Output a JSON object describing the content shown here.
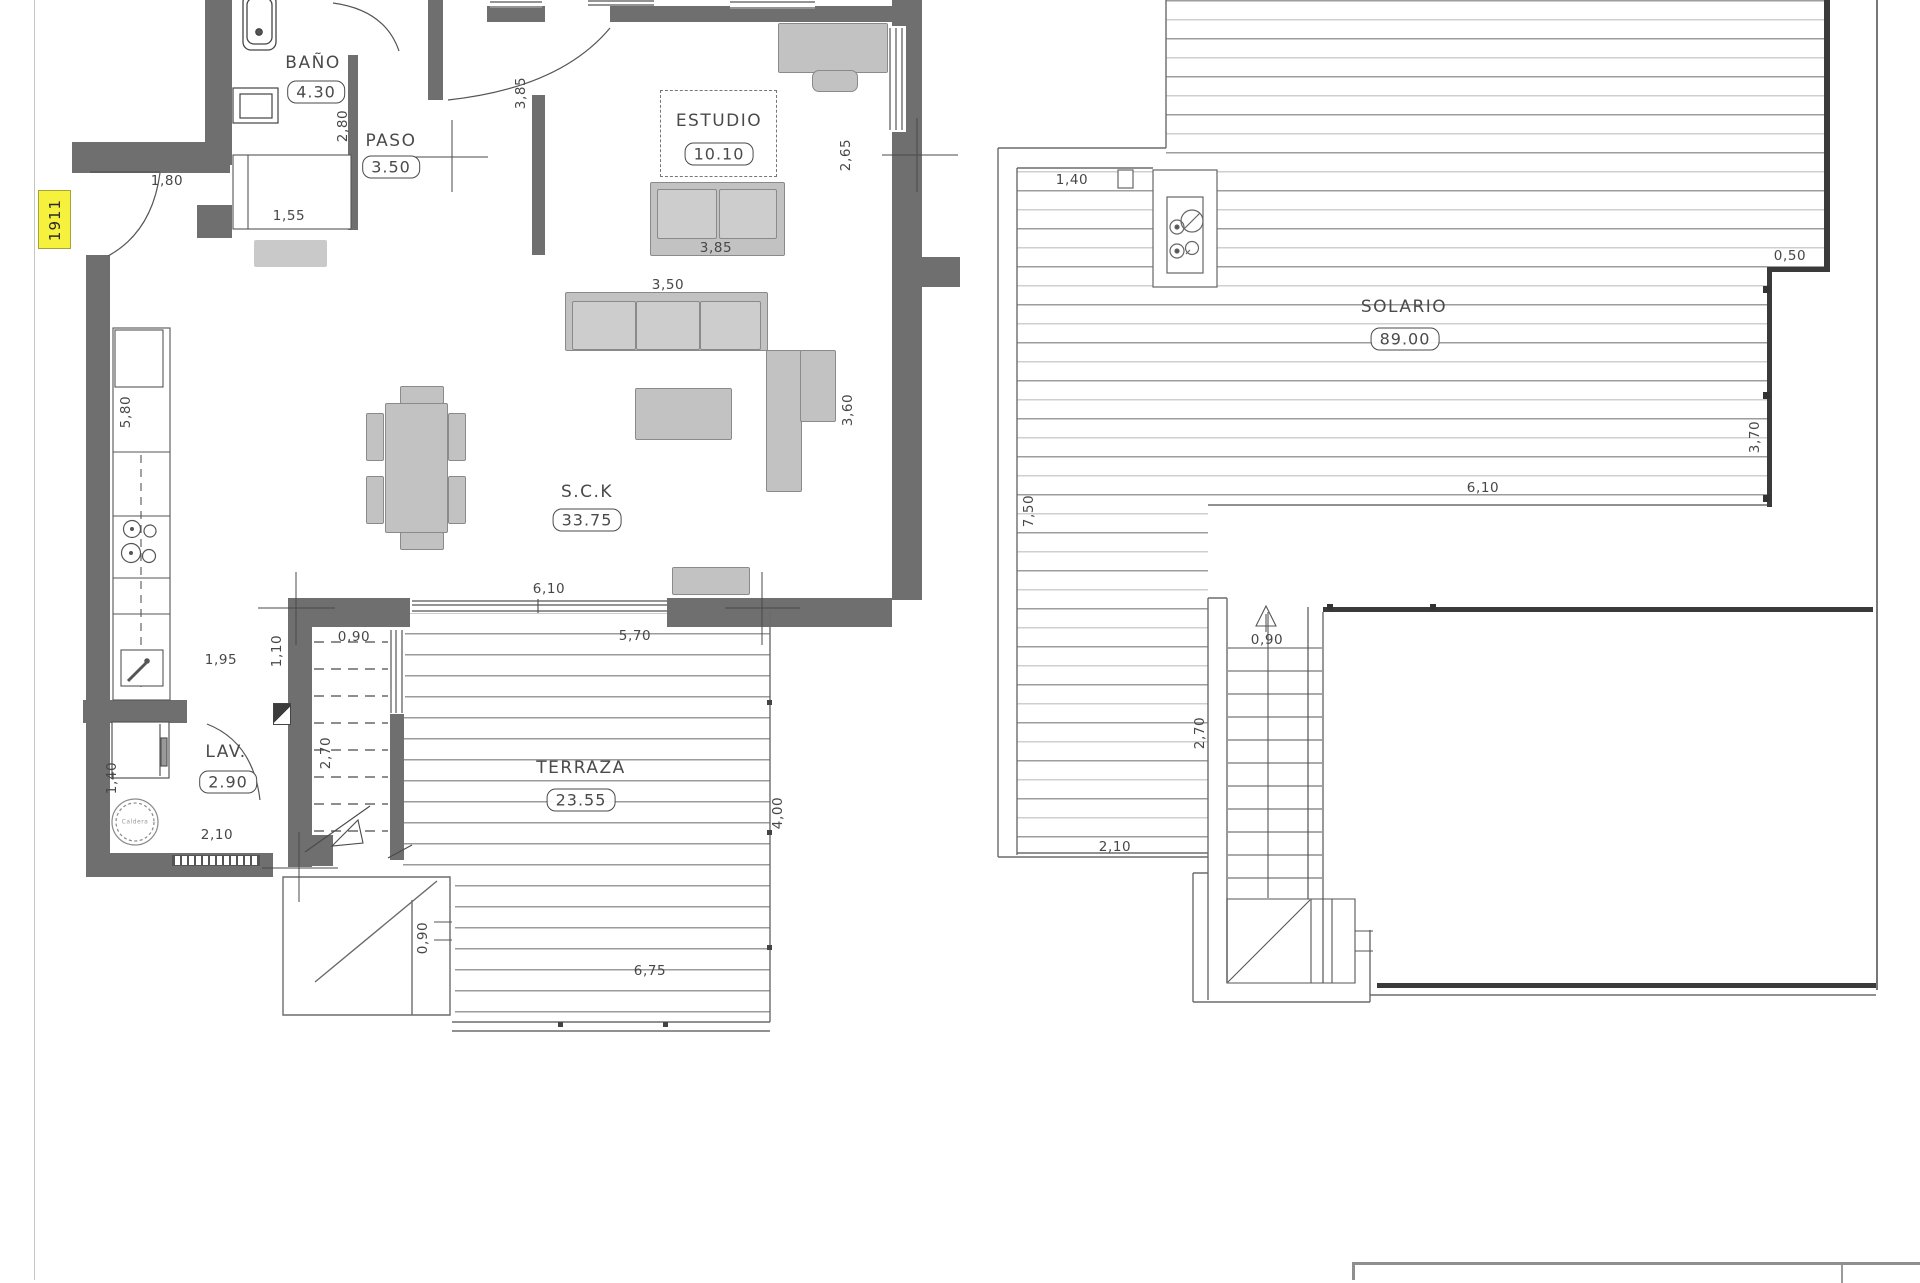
{
  "drawing": {
    "unit_tag": "1911",
    "rooms": [
      {
        "name": "BAÑO",
        "area": "4.30"
      },
      {
        "name": "PASO",
        "area": "3.50"
      },
      {
        "name": "ESTUDIO",
        "area": "10.10"
      },
      {
        "name": "S.C.K",
        "area": "33.75"
      },
      {
        "name": "LAV.",
        "area": "2.90"
      },
      {
        "name": "TERRAZA",
        "area": "23.55"
      },
      {
        "name": "SOLARIO",
        "area": "89.00"
      }
    ],
    "equipment": {
      "boiler_label": "Caldera"
    },
    "dimensions": [
      {
        "t": "1,80",
        "x": 167,
        "y": 181,
        "r": 0
      },
      {
        "t": "2,80",
        "x": 343,
        "y": 126,
        "r": 1
      },
      {
        "t": "1,55",
        "x": 289,
        "y": 216,
        "r": 0
      },
      {
        "t": "3,85",
        "x": 521,
        "y": 93,
        "r": 1
      },
      {
        "t": "2,65",
        "x": 846,
        "y": 155,
        "r": 1
      },
      {
        "t": "3,85",
        "x": 716,
        "y": 248,
        "r": 0
      },
      {
        "t": "3,50",
        "x": 668,
        "y": 285,
        "r": 0
      },
      {
        "t": "3,60",
        "x": 848,
        "y": 410,
        "r": 1
      },
      {
        "t": "5,80",
        "x": 126,
        "y": 412,
        "r": 1
      },
      {
        "t": "1,95",
        "x": 221,
        "y": 660,
        "r": 0
      },
      {
        "t": "1,10",
        "x": 277,
        "y": 651,
        "r": 1
      },
      {
        "t": "0,90",
        "x": 354,
        "y": 637,
        "r": 0
      },
      {
        "t": "6,10",
        "x": 549,
        "y": 589,
        "r": 0
      },
      {
        "t": "5,70",
        "x": 635,
        "y": 636,
        "r": 0
      },
      {
        "t": "2,70",
        "x": 326,
        "y": 753,
        "r": 1
      },
      {
        "t": "4,00",
        "x": 778,
        "y": 813,
        "r": 1
      },
      {
        "t": "1,40",
        "x": 112,
        "y": 778,
        "r": 1
      },
      {
        "t": "2,10",
        "x": 217,
        "y": 835,
        "r": 0
      },
      {
        "t": "0,90",
        "x": 423,
        "y": 938,
        "r": 1
      },
      {
        "t": "6,75",
        "x": 650,
        "y": 971,
        "r": 0
      },
      {
        "t": "1,40",
        "x": 1072,
        "y": 180,
        "r": 0
      },
      {
        "t": "0,50",
        "x": 1790,
        "y": 256,
        "r": 0
      },
      {
        "t": "7,50",
        "x": 1029,
        "y": 511,
        "r": 1
      },
      {
        "t": "3,70",
        "x": 1755,
        "y": 437,
        "r": 1
      },
      {
        "t": "6,10",
        "x": 1483,
        "y": 488,
        "r": 0
      },
      {
        "t": "0,90",
        "x": 1267,
        "y": 640,
        "r": 0
      },
      {
        "t": "2,70",
        "x": 1200,
        "y": 733,
        "r": 1
      },
      {
        "t": "2,10",
        "x": 1115,
        "y": 847,
        "r": 0
      }
    ]
  }
}
